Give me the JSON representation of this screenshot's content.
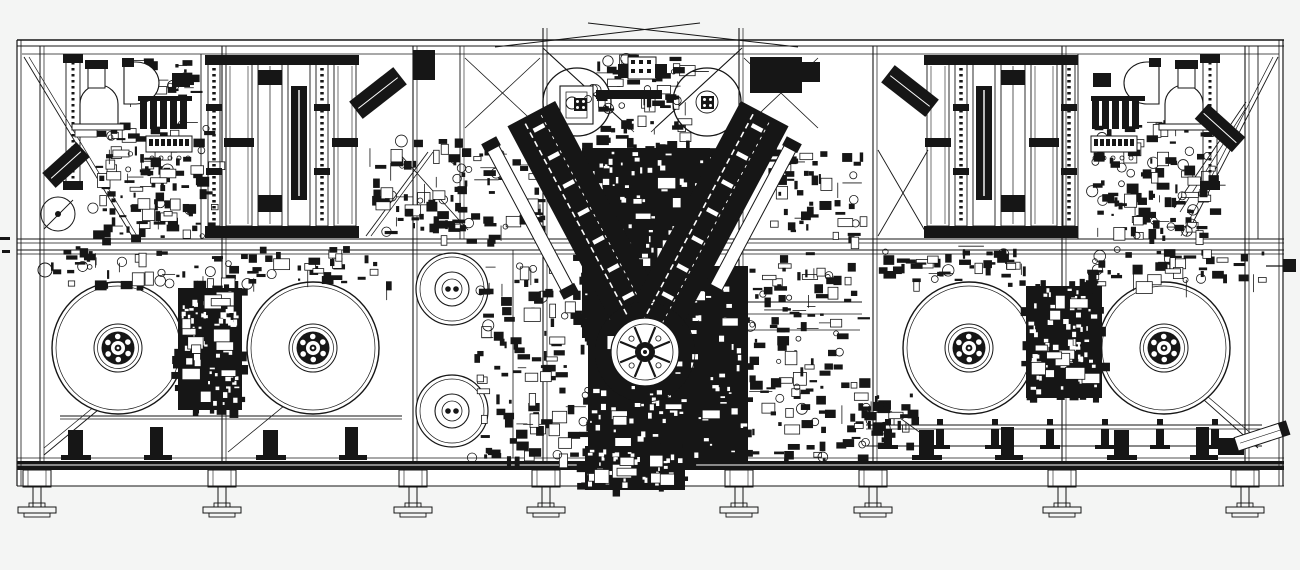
{
  "meta": {
    "canvas": {
      "w": 1300,
      "h": 570
    },
    "colors": {
      "bg": "#f4f5f4",
      "paper": "#ffffff",
      "ink": "#161616"
    }
  },
  "drawing": {
    "paper": [
      17,
      40,
      1267,
      446
    ],
    "hlines": [
      [
        17,
        40,
        1284,
        1.4
      ],
      [
        17,
        46,
        1284,
        0.9
      ],
      [
        22,
        54,
        1279,
        0.7
      ],
      [
        17,
        239,
        1284,
        1.1
      ],
      [
        17,
        243,
        1284,
        0.7
      ],
      [
        17,
        250,
        1284,
        1.1
      ],
      [
        17,
        254,
        1284,
        0.7
      ],
      [
        17,
        458,
        1284,
        0.8
      ],
      [
        17,
        486,
        1284,
        1.1
      ],
      [
        60,
        416,
        402,
        0.9
      ],
      [
        60,
        419,
        402,
        0.7
      ],
      [
        680,
        302,
        862,
        0.9
      ],
      [
        680,
        314,
        862,
        0.7
      ],
      [
        745,
        330,
        860,
        0.7
      ],
      [
        1266,
        266,
        1293,
        1.2
      ]
    ],
    "vlines": [
      [
        17,
        40,
        486,
        1.2
      ],
      [
        21,
        40,
        486,
        0.8
      ],
      [
        1279,
        40,
        486,
        0.8
      ],
      [
        1283,
        40,
        486,
        1.2
      ],
      [
        40,
        46,
        461,
        1.0
      ],
      [
        44,
        46,
        461,
        0.7
      ],
      [
        201,
        54,
        239,
        0.9
      ],
      [
        222,
        46,
        461,
        1.1
      ],
      [
        226,
        46,
        461,
        0.7
      ],
      [
        413,
        46,
        461,
        1.1
      ],
      [
        417,
        46,
        461,
        0.7
      ],
      [
        460,
        46,
        239,
        0.9
      ],
      [
        464,
        46,
        239,
        0.6
      ],
      [
        513,
        250,
        458,
        0.8
      ],
      [
        543,
        28,
        461,
        1.1
      ],
      [
        547,
        28,
        461,
        0.7
      ],
      [
        627,
        352,
        461,
        0.9
      ],
      [
        641,
        352,
        461,
        0.9
      ],
      [
        739,
        28,
        461,
        1.1
      ],
      [
        743,
        28,
        461,
        0.7
      ],
      [
        873,
        46,
        461,
        1.1
      ],
      [
        877,
        46,
        461,
        0.7
      ],
      [
        1062,
        46,
        461,
        1.1
      ],
      [
        1066,
        46,
        461,
        0.7
      ],
      [
        1078,
        54,
        239,
        0.9
      ],
      [
        1245,
        46,
        461,
        1.1
      ],
      [
        1249,
        46,
        461,
        0.7
      ],
      [
        1258,
        46,
        239,
        0.9
      ]
    ],
    "dlines": [
      [
        24,
        57,
        132,
        236,
        0.9
      ],
      [
        29,
        57,
        137,
        236,
        0.7
      ],
      [
        366,
        236,
        428,
        152,
        0.9
      ],
      [
        371,
        236,
        433,
        152,
        0.7
      ],
      [
        398,
        152,
        468,
        230,
        0.9
      ],
      [
        543,
        48,
        630,
        128,
        0.9
      ],
      [
        547,
        52,
        634,
        132,
        0.7
      ],
      [
        742,
        48,
        655,
        128,
        0.9
      ],
      [
        738,
        52,
        651,
        132,
        0.7
      ],
      [
        465,
        58,
        540,
        128,
        0.8
      ],
      [
        540,
        58,
        465,
        128,
        0.8
      ],
      [
        744,
        58,
        818,
        128,
        0.8
      ],
      [
        818,
        58,
        744,
        128,
        0.8
      ],
      [
        878,
        150,
        928,
        236,
        0.9
      ],
      [
        928,
        150,
        878,
        236,
        0.9
      ],
      [
        1246,
        102,
        1174,
        208,
        0.9
      ],
      [
        1246,
        108,
        1180,
        212,
        0.7
      ],
      [
        1278,
        57,
        1186,
        236,
        0.9
      ],
      [
        1273,
        57,
        1181,
        236,
        0.7
      ],
      [
        44,
        455,
        170,
        350,
        0.9
      ],
      [
        44,
        448,
        163,
        350,
        0.7
      ],
      [
        228,
        452,
        330,
        368,
        0.8
      ],
      [
        878,
        402,
        922,
        434,
        0.9
      ],
      [
        1168,
        368,
        1258,
        448,
        0.9
      ],
      [
        1174,
        368,
        1260,
        441,
        0.7
      ],
      [
        495,
        47,
        700,
        23,
        1.0
      ],
      [
        588,
        23,
        798,
        47,
        1.0
      ],
      [
        44,
        229,
        73,
        200,
        0.9
      ]
    ],
    "base_band": [
      17,
      461,
      1267,
      9
    ],
    "base_band_slit_y": 465,
    "reels": {
      "r": 66,
      "centers": [
        [
          118,
          348
        ],
        [
          313,
          348
        ],
        [
          969,
          348
        ],
        [
          1164,
          348
        ]
      ]
    },
    "hub_rolls": {
      "r": 36,
      "centers": [
        [
          452,
          289
        ],
        [
          452,
          411
        ]
      ]
    },
    "top_rolls": {
      "r": 34,
      "left": [
        577,
        102
      ],
      "right": [
        707,
        102
      ]
    },
    "small_rolls": [
      [
        58,
        214,
        17
      ],
      [
        45,
        270,
        7
      ]
    ],
    "clusters": [
      {
        "name": "upper-left-machinery",
        "x": 92,
        "y": 122,
        "w": 120,
        "h": 116,
        "n": 130,
        "seed": 11,
        "style": "scatter"
      },
      {
        "name": "top-left-bits",
        "x": 122,
        "y": 58,
        "w": 70,
        "h": 40,
        "n": 30,
        "seed": 161,
        "style": "scatter"
      },
      {
        "name": "mid-band-left",
        "x": 50,
        "y": 246,
        "w": 360,
        "h": 38,
        "n": 85,
        "seed": 22,
        "style": "scatter"
      },
      {
        "name": "pre-v-left",
        "x": 368,
        "y": 138,
        "w": 88,
        "h": 98,
        "n": 60,
        "seed": 33,
        "style": "scatter"
      },
      {
        "name": "top-center",
        "x": 592,
        "y": 54,
        "w": 100,
        "h": 84,
        "n": 70,
        "seed": 44,
        "style": "scatter"
      },
      {
        "name": "v-left-side",
        "x": 452,
        "y": 146,
        "w": 92,
        "h": 94,
        "n": 55,
        "seed": 55,
        "style": "scatter"
      },
      {
        "name": "v-right-side",
        "x": 768,
        "y": 148,
        "w": 94,
        "h": 90,
        "n": 55,
        "seed": 66,
        "style": "scatter"
      },
      {
        "name": "v-core",
        "x": 582,
        "y": 148,
        "w": 128,
        "h": 190,
        "n": 95,
        "seed": 77,
        "style": "dense"
      },
      {
        "name": "center-bottom-left",
        "x": 472,
        "y": 266,
        "w": 120,
        "h": 192,
        "n": 115,
        "seed": 88,
        "style": "scatter"
      },
      {
        "name": "center-bottom-core",
        "x": 588,
        "y": 266,
        "w": 160,
        "h": 196,
        "n": 95,
        "seed": 99,
        "style": "dense"
      },
      {
        "name": "center-bottom-right",
        "x": 748,
        "y": 252,
        "w": 112,
        "h": 208,
        "n": 125,
        "seed": 101,
        "style": "scatter"
      },
      {
        "name": "left-reel-gap",
        "x": 178,
        "y": 288,
        "w": 64,
        "h": 122,
        "n": 70,
        "seed": 111,
        "style": "dense"
      },
      {
        "name": "right-reel-gap",
        "x": 1026,
        "y": 286,
        "w": 76,
        "h": 112,
        "n": 70,
        "seed": 121,
        "style": "dense"
      },
      {
        "name": "right-mid-band-inner",
        "x": 873,
        "y": 246,
        "w": 150,
        "h": 38,
        "n": 48,
        "seed": 181,
        "style": "scatter"
      },
      {
        "name": "right-mid-band-outer",
        "x": 1085,
        "y": 248,
        "w": 180,
        "h": 34,
        "n": 50,
        "seed": 131,
        "style": "scatter"
      },
      {
        "name": "upper-right-machinery",
        "x": 1090,
        "y": 120,
        "w": 120,
        "h": 116,
        "n": 120,
        "seed": 171,
        "style": "scatter"
      },
      {
        "name": "conveyor-head",
        "x": 856,
        "y": 393,
        "w": 60,
        "h": 52,
        "n": 35,
        "seed": 141,
        "style": "scatter"
      },
      {
        "name": "under-center-block",
        "x": 585,
        "y": 446,
        "w": 100,
        "h": 44,
        "n": 45,
        "seed": 151,
        "style": "dense"
      }
    ],
    "banks": {
      "y_top": 55,
      "y_bot": 238,
      "left": [
        [
          208,
          12,
          "dot"
        ],
        [
          226,
          26,
          "rail"
        ],
        [
          258,
          24,
          "rail2"
        ],
        [
          288,
          22,
          "dark"
        ],
        [
          316,
          12,
          "dot"
        ],
        [
          334,
          22,
          "rail"
        ]
      ],
      "right": [
        [
          927,
          22,
          "rail"
        ],
        [
          955,
          12,
          "dot"
        ],
        [
          973,
          22,
          "dark"
        ],
        [
          1001,
          24,
          "rail2"
        ],
        [
          1031,
          26,
          "rail"
        ],
        [
          1063,
          12,
          "dot"
        ]
      ]
    },
    "side_columns": [
      [
        66,
        58,
        14,
        125
      ],
      [
        1203,
        58,
        14,
        125
      ]
    ],
    "v_bands": {
      "left": {
        "cx": 590,
        "cy": 224,
        "w": 54,
        "len": 250,
        "a": -28
      },
      "right": {
        "cx": 706,
        "cy": 224,
        "w": 54,
        "len": 250,
        "a": 28
      },
      "outriggers": [
        {
          "cx": 530,
          "cy": 218,
          "w": 13,
          "len": 160,
          "a": -28
        },
        {
          "cx": 753,
          "cy": 218,
          "w": 13,
          "len": 160,
          "a": 28
        }
      ]
    },
    "turret": {
      "cx": 645,
      "cy": 352,
      "r_outer": 50,
      "r_face": 34,
      "r_inner": 28,
      "spokes": 8
    },
    "conveyor": {
      "x1": 866,
      "x2": 1262,
      "rail_ys": [
        425,
        429,
        446
      ],
      "stanchions": [
        888,
        940,
        995,
        1050,
        1105,
        1160,
        1215
      ],
      "blob": [
        1218,
        438,
        26,
        17
      ],
      "chute": {
        "cx": 1262,
        "cy": 436,
        "w": 54,
        "h": 14,
        "a": -18
      }
    },
    "legs": {
      "xs": [
        37,
        222,
        413,
        546,
        739,
        873,
        1062,
        1245
      ]
    },
    "stands_on": [
      0,
      1,
      2,
      3
    ],
    "over": {
      "black_rects": [
        [
          413,
          50,
          22,
          30
        ],
        [
          750,
          57,
          52,
          36
        ],
        [
          802,
          62,
          18,
          20
        ],
        [
          85,
          60,
          23,
          9
        ],
        [
          172,
          73,
          18,
          14
        ],
        [
          138,
          96,
          54,
          5
        ],
        [
          140,
          101,
          7,
          28
        ],
        [
          150,
          101,
          7,
          28
        ],
        [
          160,
          101,
          7,
          28
        ],
        [
          170,
          101,
          7,
          28
        ],
        [
          180,
          101,
          7,
          28
        ],
        [
          122,
          58,
          12,
          9
        ],
        [
          1175,
          60,
          23,
          9
        ],
        [
          1093,
          73,
          18,
          14
        ],
        [
          1091,
          96,
          54,
          5
        ],
        [
          1092,
          101,
          7,
          28
        ],
        [
          1102,
          101,
          7,
          28
        ],
        [
          1112,
          101,
          7,
          28
        ],
        [
          1122,
          101,
          7,
          28
        ],
        [
          1132,
          101,
          7,
          28
        ],
        [
          1149,
          58,
          12,
          9
        ],
        [
          618,
          64,
          10,
          14
        ],
        [
          655,
          64,
          12,
          14
        ],
        [
          596,
          90,
          66,
          9
        ],
        [
          149,
          139,
          4,
          7
        ],
        [
          155,
          139,
          4,
          7
        ],
        [
          161,
          139,
          4,
          7
        ],
        [
          167,
          139,
          4,
          7
        ],
        [
          173,
          139,
          4,
          7
        ],
        [
          179,
          139,
          4,
          7
        ],
        [
          185,
          139,
          4,
          7
        ],
        [
          1094,
          139,
          4,
          7
        ],
        [
          1100,
          139,
          4,
          7
        ],
        [
          1106,
          139,
          4,
          7
        ],
        [
          1112,
          139,
          4,
          7
        ],
        [
          1118,
          139,
          4,
          7
        ],
        [
          1124,
          139,
          4,
          7
        ],
        [
          1130,
          139,
          4,
          7
        ],
        [
          631,
          60,
          4,
          4
        ],
        [
          639,
          60,
          4,
          4
        ],
        [
          647,
          60,
          4,
          4
        ],
        [
          631,
          69,
          4,
          4
        ],
        [
          639,
          69,
          4,
          4
        ],
        [
          647,
          69,
          4,
          4
        ],
        [
          1283,
          259,
          13,
          13
        ],
        [
          0,
          237,
          10,
          3
        ],
        [
          2,
          250,
          8,
          3
        ]
      ],
      "outline_rects": [
        [
          88,
          66,
          17,
          22,
          1
        ],
        [
          72,
          124,
          52,
          6,
          1
        ],
        [
          146,
          136,
          46,
          16,
          1
        ],
        [
          75,
          130,
          22,
          7,
          0.8
        ],
        [
          1178,
          66,
          17,
          22,
          1
        ],
        [
          1159,
          124,
          52,
          6,
          1
        ],
        [
          1091,
          136,
          46,
          16,
          1
        ],
        [
          560,
          86,
          33,
          38,
          1.1
        ],
        [
          566,
          92,
          21,
          26,
          0.7
        ],
        [
          628,
          57,
          28,
          22,
          1
        ]
      ],
      "rot_rects": [
        {
          "cx": 378,
          "cy": 93,
          "w": 56,
          "h": 22,
          "a": -38
        },
        {
          "cx": 910,
          "cy": 91,
          "w": 56,
          "h": 22,
          "a": 38
        },
        {
          "cx": 66,
          "cy": 165,
          "w": 46,
          "h": 20,
          "a": -42
        },
        {
          "cx": 1220,
          "cy": 128,
          "w": 50,
          "h": 20,
          "a": 42
        }
      ],
      "paths": [
        [
          "M80,124 L80,104 A19,19 0 0 1 118,104 L118,124 Z",
          1.1
        ],
        [
          "M1165,124 L1165,104 A19,19 0 0 1 1203,104 L1203,124 Z",
          1.1
        ],
        [
          "M124,62 L136,62 A23,21 0 0 1 136,104 L124,104 Z",
          1.1
        ],
        [
          "M1159,62 L1147,62 A23,21 0 0 0 1147,104 L1159,104 Z",
          1.1
        ]
      ],
      "circles": [
        [
          572,
          103,
          6,
          1
        ],
        [
          588,
          99,
          3.5,
          0.8
        ],
        [
          707,
          102,
          11,
          0.9
        ],
        [
          152,
          158,
          2,
          0.8
        ],
        [
          161,
          158,
          2,
          0.8
        ],
        [
          170,
          158,
          2,
          0.8
        ],
        [
          179,
          158,
          2,
          0.8
        ],
        [
          188,
          158,
          2,
          0.8
        ],
        [
          1095,
          158,
          2,
          0.8
        ],
        [
          1104,
          158,
          2,
          0.8
        ],
        [
          1113,
          158,
          2,
          0.8
        ],
        [
          1122,
          158,
          2,
          0.8
        ],
        [
          1131,
          158,
          2,
          0.8
        ]
      ],
      "dot_squares": [
        {
          "x": 574,
          "y": 98,
          "s": 13
        },
        {
          "x": 701,
          "y": 96,
          "s": 13
        }
      ]
    }
  }
}
